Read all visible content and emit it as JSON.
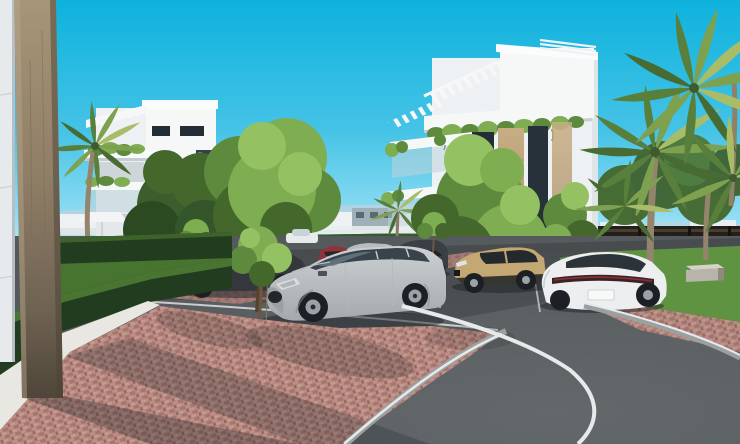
{
  "scene": {
    "title": "Residential complex exterior 3D render",
    "type": "architectural-visualization",
    "elements": [
      "apartment-building-left",
      "apartment-building-right",
      "roof-pergolas",
      "balconies-with-hanging-plants",
      "timber-pillar-foreground",
      "white-wall-panel",
      "boxwood-hedges",
      "lawn",
      "palm-trees",
      "deciduous-trees",
      "saplings",
      "parking-lot",
      "brick-walkway",
      "brick-plaza",
      "curved-asphalt-road",
      "white-road-markings",
      "gravel-strip",
      "concrete-benches",
      "privacy-fence",
      "distant-town-skyline",
      "terrace-umbrella",
      "sun-loungers"
    ],
    "vehicles": [
      {
        "name": "silver-suv",
        "color": "#ccd0d2"
      },
      {
        "name": "dark-sedan",
        "color": "#34383d"
      },
      {
        "name": "dark-gray-suv",
        "color": "#3a3f45"
      },
      {
        "name": "sand-crossover",
        "color": "#c3a873"
      },
      {
        "name": "white-fastback-sedan",
        "color": "#eceeef"
      },
      {
        "name": "silver-sedan-distant",
        "color": "#b6bcc0"
      },
      {
        "name": "red-hatchback-distant",
        "color": "#8e3338"
      },
      {
        "name": "white-car-distant",
        "color": "#e8ebec"
      }
    ]
  },
  "palette": {
    "sky_top": "#0eb2dd",
    "sky_mid": "#45c3e6",
    "sky_low": "#8edcf2",
    "sky_horizon": "#c2eef9",
    "haze": "#bdd2de",
    "distant_white": "#edf1f3",
    "distant_gray": "#9fb0b9",
    "white_sun": "#f6f8f8",
    "white_lit": "#eef1f3",
    "white_shade": "#dfe4e7",
    "white_deep": "#c6cdd2",
    "wood_light": "#c7ad83",
    "wood_dark": "#a18763",
    "pillar_top": "#a79577",
    "pillar_low": "#4f4639",
    "window_dark": "#232d36",
    "glass": "#a8c4d0",
    "rail_glass": "#bdd3db",
    "green_hi": "#94c161",
    "green_light": "#7fae52",
    "green_mid": "#5d8a3c",
    "green_dark": "#44672c",
    "green_deep": "#2c4a21",
    "palm1": "#7da14f",
    "palm2": "#587f3c",
    "palm3": "#a9bd68",
    "palm4": "#476b32",
    "trunk": "#95846c",
    "trunk_dark": "#6d573e",
    "hedge_face": "#213c1f",
    "hedge_top": "#4a7431",
    "lawn": "#5f9342",
    "lawn_dark": "#47752f",
    "fence_dark": "#241f19",
    "fence_slat": "#473d31",
    "asphalt": "#53585b",
    "asphalt_dark": "#42484b",
    "road_light": "#63686b",
    "line_white": "#e7e9ea",
    "curb": "#9ba1a1",
    "brick_base": "#b08078",
    "brick_light": "#bd8f86",
    "brick_mid": "#a5756f",
    "brick_light2": "#c29a8f",
    "brick_mid2": "#97675f",
    "walk_brick": "#9b7570",
    "gravel": "#e9e7e1",
    "shadow": "#1c2125",
    "car_silver": "#ccd0d2",
    "car_silver_dark": "#a3a9ad",
    "car_dark": "#34383d",
    "car_dark2": "#3a3f45",
    "car_red": "#8e3338",
    "car_sand": "#c3a873",
    "car_white": "#eceeef",
    "car_glass": "#39434b",
    "wheel": "#1c2024",
    "alloy": "#9aa2a8",
    "taillight": "#8c2e35",
    "car_sedan_silver": "#b6bcc0",
    "car_white_dist": "#e8ebec",
    "bench": "#b8b4ac",
    "bench_top": "#d6d2c8",
    "bench_side": "#8e8a82"
  }
}
